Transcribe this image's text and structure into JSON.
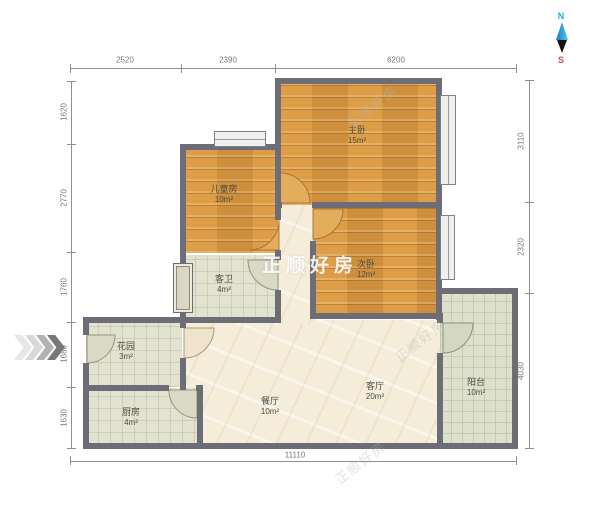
{
  "compass": {
    "north": "N",
    "south": "S"
  },
  "watermark": {
    "text": "正顺好房"
  },
  "rooms": [
    {
      "name": "儿童房",
      "area": "10m²"
    },
    {
      "name": "主卧",
      "area": "15m²"
    },
    {
      "name": "次卧",
      "area": "12m²"
    },
    {
      "name": "客卫",
      "area": "4m²"
    },
    {
      "name": "花园",
      "area": "3m²"
    },
    {
      "name": "厨房",
      "area": "4m²"
    },
    {
      "name": "餐厅",
      "area": "10m²"
    },
    {
      "name": "客厅",
      "area": "20m²"
    },
    {
      "name": "阳台",
      "area": "10m²"
    }
  ],
  "dimensions": {
    "top": [
      "2520",
      "2390",
      "6200"
    ],
    "bottom": [
      "11110"
    ],
    "left": [
      "1620",
      "2770",
      "1760",
      "1680",
      "1630"
    ],
    "right": [
      "3110",
      "2320",
      "4030"
    ]
  },
  "colors": {
    "wall": "#6d6d77",
    "wood_floor": "#d9973f",
    "tile_floor": "#e2e2d0",
    "balcony_floor": "#dde1cc",
    "marble_floor": "#f5ecd9",
    "compass_north": "#17b0c8",
    "compass_south": "#c34f4f"
  }
}
